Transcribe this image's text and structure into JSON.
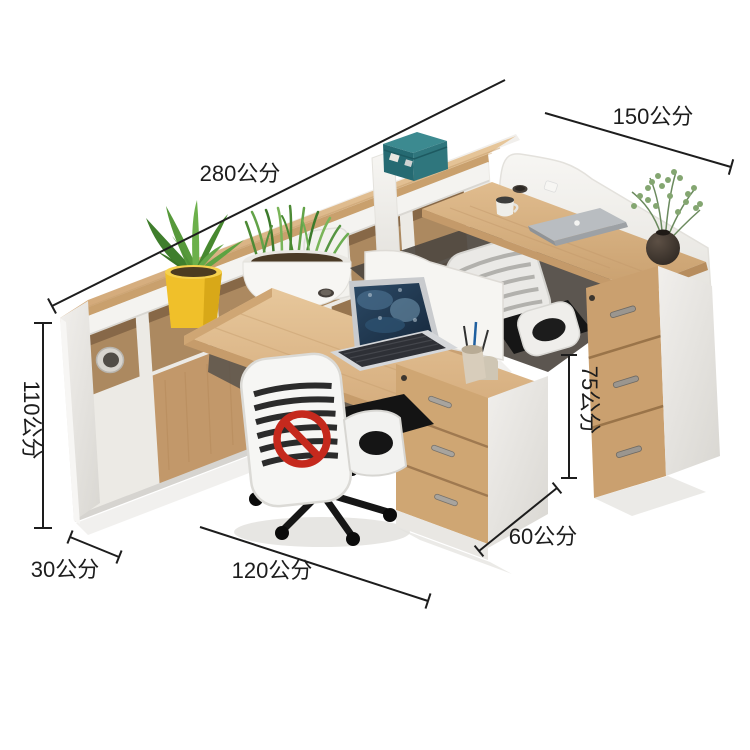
{
  "meta": {
    "type": "product-dimension-photo",
    "subject": "office workstation combination desk with cabinets",
    "unit": "公分",
    "background": "#ffffff"
  },
  "annotations": {
    "credenza_length": {
      "label": "280公分",
      "value": 280
    },
    "right_desk_length": {
      "label": "150公分",
      "value": 150
    },
    "cabinet_height": {
      "label": "110公分",
      "value": 110
    },
    "desk_height": {
      "label": "75公分",
      "value": 75
    },
    "cabinet_depth": {
      "label": "30公分",
      "value": 30
    },
    "desk_length": {
      "label": "120公分",
      "value": 120
    },
    "desk_depth": {
      "label": "60公分",
      "value": 60
    }
  },
  "icons": {
    "prohibition": "red circle with diagonal slash (no-symbol watermark on chair)"
  },
  "objects": [
    "credenza-shelf-cabinet",
    "teal-storage-box",
    "potted-plant-yellow-pot",
    "potted-plant-white-pot",
    "eucalyptus-vase-plant",
    "privacy-screen",
    "divider-panel",
    "office-chair-white",
    "office-chair-gray",
    "laptop-open",
    "laptop-closed",
    "drawer-pedestal-center",
    "drawer-pedestal-right",
    "pen-holder",
    "paper-tube",
    "printer-box",
    "coffee-cup"
  ],
  "colors": {
    "wood_top": "#dcb588",
    "wood_front": "#c89c6c",
    "panel_white": "#f3f2ef",
    "box_teal": "#256a72",
    "pot_yellow": "#f0c02a",
    "plant_green": "#569a3a",
    "prohibition_red": "#c5291d",
    "dimension_line": "#1d1d1d",
    "screen_blue": "#20394f"
  }
}
